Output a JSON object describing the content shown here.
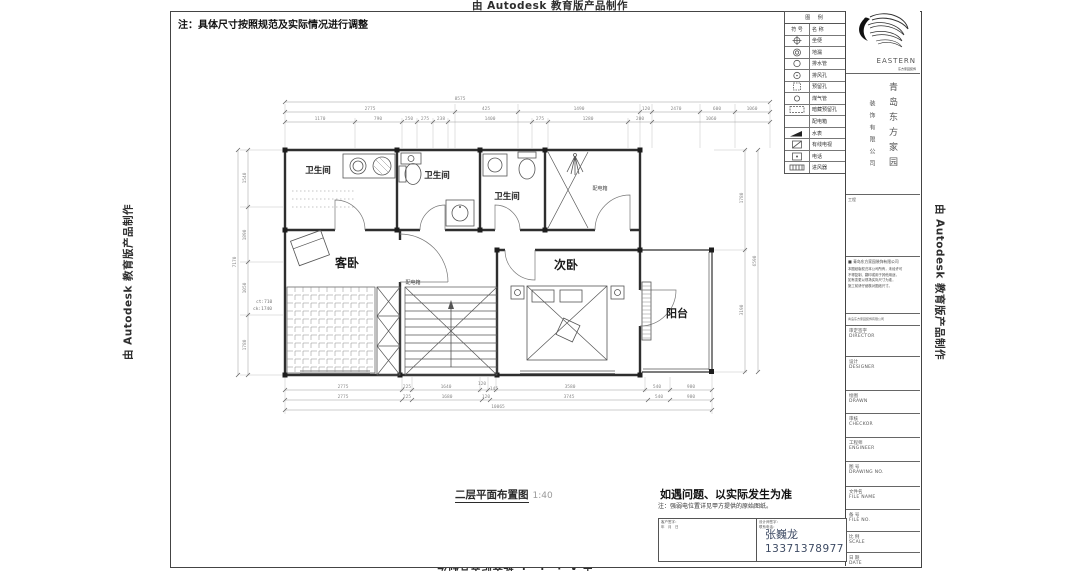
{
  "watermark": "由 Autodesk 教育版产品制作",
  "note": "注：具体尺寸按照规范及实际情况进行调整",
  "legend": {
    "title": "图  例",
    "col_symbol": "符 号",
    "col_name": "名 称",
    "rows": [
      {
        "symbol": "crossed-circle",
        "name": "坐便"
      },
      {
        "symbol": "double-circle",
        "name": "地漏"
      },
      {
        "symbol": "circle",
        "name": "排水管"
      },
      {
        "symbol": "circle-dot",
        "name": "排风孔"
      },
      {
        "symbol": "dashed-square",
        "name": "预留孔"
      },
      {
        "symbol": "circle-small",
        "name": "煤气管"
      },
      {
        "symbol": "dashed-rect",
        "name": "暗藏预留孔"
      },
      {
        "symbol": "none",
        "name": "配电箱"
      },
      {
        "symbol": "black-wedge",
        "name": "水表"
      },
      {
        "symbol": "rect-x",
        "name": "有线电视"
      },
      {
        "symbol": "rect-dot",
        "name": "电话"
      },
      {
        "symbol": "rect-ticks",
        "name": "进风器"
      }
    ]
  },
  "plan": {
    "rooms": {
      "bath_left": "卫生间",
      "bath_mid": "卫生间",
      "bath_right": "卫生间",
      "guest_bedroom": "客卧",
      "second_bedroom": "次卧",
      "balcony": "阳台",
      "distribution_box_upper": "配电箱",
      "distribution_box_lower": "配电箱"
    },
    "annotations": {
      "ct": "ct:710",
      "ck": "ck:1740"
    },
    "dims": {
      "top_overall": "8575",
      "top_mid": [
        "2775",
        "425",
        "1490",
        "120",
        "2470",
        "600",
        "1060"
      ],
      "top_inner": [
        "1170",
        "790",
        "250",
        "275",
        "238",
        "1400",
        "275",
        "1280",
        "200",
        "1060"
      ],
      "bottom_inner": [
        "2775",
        "225",
        "1640",
        "120",
        "145",
        "3580",
        "540",
        "980"
      ],
      "bottom_mid": [
        "2775",
        "225",
        "1680",
        "120",
        "3745",
        "540",
        "980"
      ],
      "bottom_overall": "10065",
      "left": [
        "1540",
        "1890",
        "1050",
        "1780",
        "7170"
      ],
      "right": [
        "1780",
        "3190",
        "6590"
      ]
    }
  },
  "drawing_title": {
    "text": "二层平面布置图",
    "scale": "1:40"
  },
  "footer": {
    "notice": "如遇问题、以实际发生为准",
    "notice_note": "注：强弱电位置详见甲方提供的原始图纸。",
    "client_sign_label": "客户签字：",
    "client_date_label": "年　月　日",
    "designer_sign_label": "设计师签字：",
    "designer_phone_label": "联系电话：",
    "designer_name": "张巍龙",
    "designer_phone": "13371378977"
  },
  "titleblock": {
    "logo_text": "EASTERN",
    "logo_sub": "东方家园装饰",
    "company_col_right": "青岛东方家园",
    "company_col_left": "装饰有限公司",
    "project_label": "工程",
    "bullet_line": "青岛东方家园装饰有限公司",
    "notes": [
      "本图纸版权归本公司所有，未经许可",
      "不得复制、翻印或用于其他用途，",
      "如有变更以现场实际尺寸为准，",
      "施工前请仔细核对图纸尺寸。"
    ],
    "address_line": "青岛东方家园装饰有限公司",
    "rows": [
      {
        "cn": "审定签字",
        "en": "DIRECTOR"
      },
      {
        "cn": "设计",
        "en": "DESIGNER"
      },
      {
        "cn": "绘图",
        "en": "DRAWN"
      },
      {
        "cn": "审核",
        "en": "CHECKOR"
      },
      {
        "cn": "工程师",
        "en": "ENGINEER"
      },
      {
        "cn": "图 号",
        "en": "DRAWING NO."
      },
      {
        "cn": "文件名",
        "en": "FILE NAME"
      },
      {
        "cn": "备 号",
        "en": "FILE NO."
      },
      {
        "cn": "比 例",
        "en": "SCALE"
      },
      {
        "cn": "日 期",
        "en": "DATE"
      }
    ]
  }
}
